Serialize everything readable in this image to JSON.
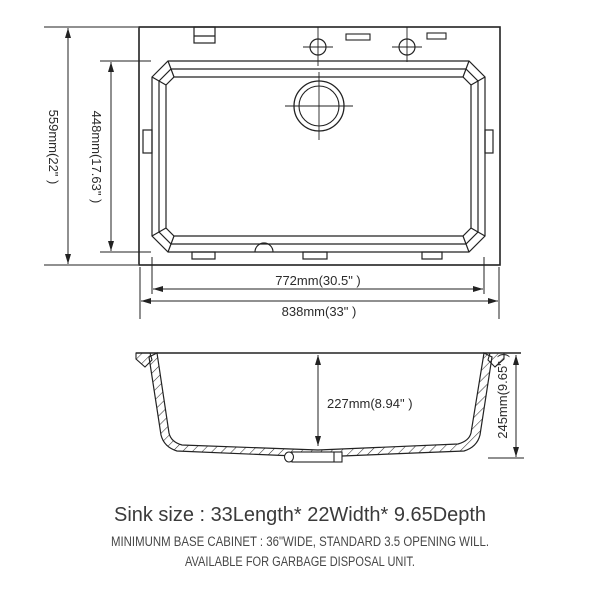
{
  "drawing": {
    "background": "#ffffff",
    "line_color": "#222222",
    "top_view": {
      "name": "sink top view",
      "dimensions": {
        "overall_front_to_back": "559mm(22\" )",
        "bowl_front_to_back": "448mm(17.63\" )",
        "bowl_length": "772mm(30.5\" )",
        "overall_length": "838mm(33\" )"
      }
    },
    "section_view": {
      "name": "sink cross section",
      "dimensions": {
        "bowl_inner_depth": "227mm(8.94\" )",
        "overall_depth": "245mm(9.65\" )"
      }
    },
    "caption": {
      "title": "Sink size :  33Length* 22Width* 9.65Depth",
      "note1": "MINIMUNM BASE CABINET : 36\"WIDE,   STANDARD 3.5 OPENING WILL.",
      "note2": "AVAILABLE FOR GARBAGE DISPOSAL UNIT."
    }
  }
}
